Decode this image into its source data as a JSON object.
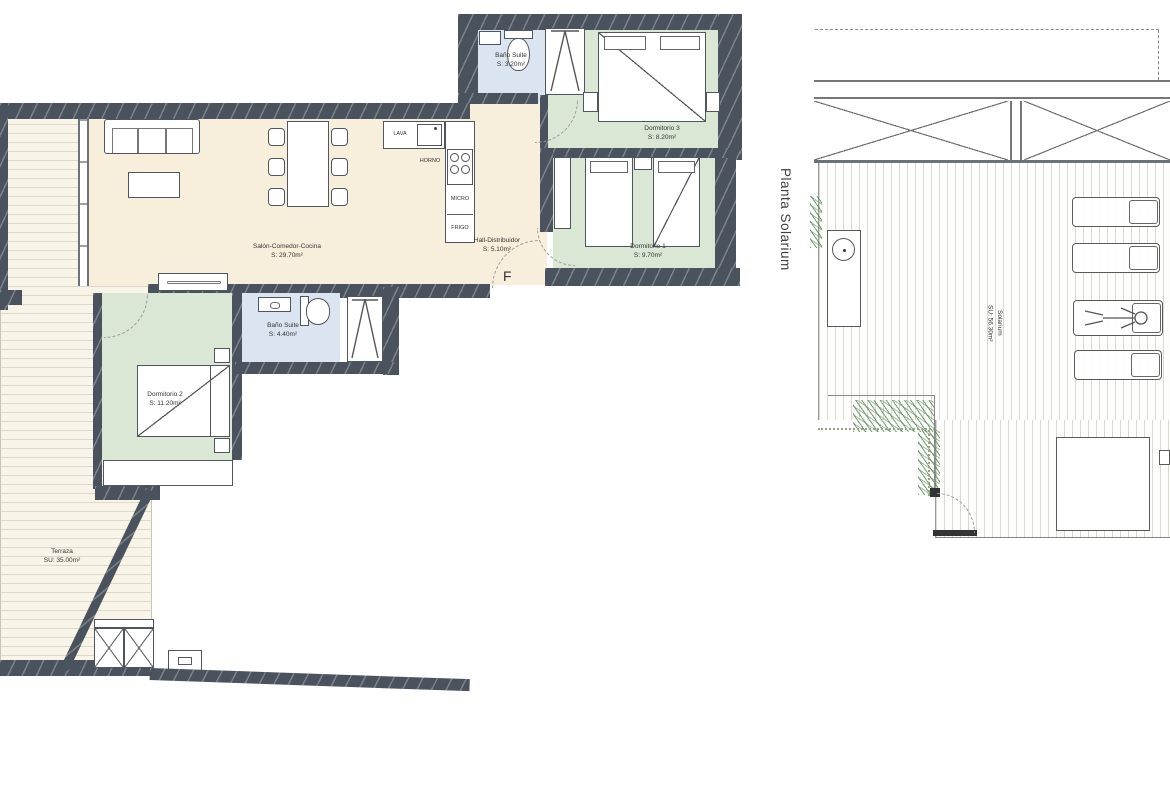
{
  "plan_title_vertical": "Planta Solarium",
  "rooms": {
    "bano_suite_3": {
      "name": "Baño Suite",
      "area": "S: 3.20m²"
    },
    "dormitorio_3": {
      "name": "Dormitorio 3",
      "area": "S: 8.20m²"
    },
    "dormitorio_1": {
      "name": "Dormitorio 1",
      "area": "S: 9.70m²"
    },
    "salon": {
      "name": "Salón-Comedor-Cocina",
      "area": "S: 29.70m²"
    },
    "hall": {
      "name": "Hall-Distribuidor",
      "area": "S: 5.10m²"
    },
    "bano_suite_2": {
      "name": "Baño Suite",
      "area": "S: 4.40m²"
    },
    "dormitorio_2": {
      "name": "Dormitorio 2",
      "area": "S: 11.20m²"
    },
    "terraza": {
      "name": "Terraza",
      "area": "SU: 35.00m²"
    },
    "solarium": {
      "name": "Solarium",
      "area": "SU: 56.30m²"
    }
  },
  "kitchen_labels": {
    "lava": "LAVA",
    "horno": "HORNO",
    "micro": "MICRO",
    "frigo": "FRIGO"
  },
  "entry_marker": "F",
  "colors": {
    "wall": "#4a525e",
    "living": "#f7efdc",
    "bedroom": "#d9e7d4",
    "bathroom": "#dbe5f1",
    "terrace_deck": "#f8f4e8",
    "plants": "#4e8a50"
  }
}
